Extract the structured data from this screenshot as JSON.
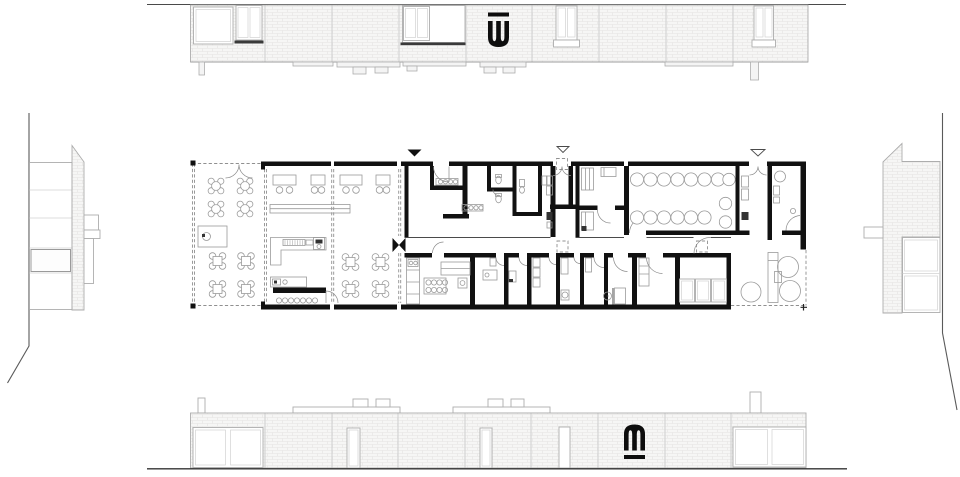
{
  "canvas": {
    "width_px": 960,
    "height_px": 477
  },
  "drawing": {
    "kind": "architectural floor plan with four elevations",
    "views": {
      "top": "long-facade-elevation-north",
      "bottom": "long-facade-elevation-south",
      "left": "side-elevation-west",
      "right": "side-elevation-east",
      "center": "ground-floor-plan"
    }
  },
  "logos": {
    "top": {
      "name": "w-overline-logo",
      "glyph": "W",
      "style": "black block W with bar above"
    },
    "bottom": {
      "name": "m-underline-logo",
      "glyph": "m",
      "style": "black block m with bar below"
    }
  },
  "colors": {
    "background": "#ffffff",
    "wall": "#111111",
    "line": "#4a4a4a",
    "furniture_line": "#9a9a9a",
    "door_arc": "#8a8a8a",
    "dash_line": "#909090",
    "frame_line": "#adadad",
    "frame_light": "#d2d2d2",
    "joint_line": "#cfcfcf",
    "brick_fill": "#f6f6f5",
    "brick_line": "#e4e3e1",
    "footing_fill": "#f4f4f4",
    "dark_fixture": "#333333",
    "sill_dark": "#3a3a3a",
    "ground_line": "#333333",
    "site_line": "#5a5a5a",
    "logo": "#0d0d0d"
  }
}
